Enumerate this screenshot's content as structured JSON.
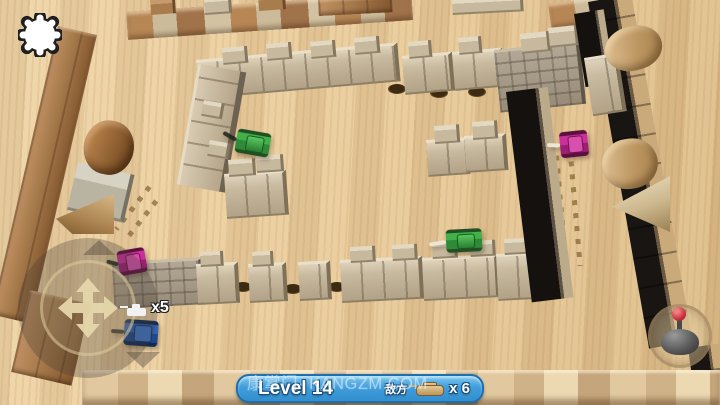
{
  "hud": {
    "settings": {
      "icon": "gear-icon"
    },
    "joystick": {
      "icon": "move-arrows-icon"
    },
    "fire_button": {
      "icon": "fire-joystick-icon"
    },
    "lives": {
      "label": "x5",
      "icon": "player-tank-icon"
    },
    "banner": {
      "level_label": "Level 14",
      "enemy_label": "敌方",
      "enemy_icon": "tank-icon",
      "enemy_count_label": "x 6",
      "bg_color": "#4aa7e2",
      "border_color": "#1d6fb0"
    },
    "watermark": "康掌门· KANGZM.COM"
  },
  "palette": {
    "wood_light": "#eed5a8",
    "wood_mid": "#e3c493",
    "border_wood": "#a5794a",
    "block_tan": "#c9bba0",
    "brick_gray": "#9a8f7c",
    "tank_green": "#3aa43a",
    "tank_purple": "#c02892",
    "tank_blue": "#2f63b5",
    "hole_brown": "#3c2b12"
  },
  "scene": {
    "walls": [
      {
        "x": 58,
        "y": 26,
        "w": 40,
        "h": 296,
        "rot": 13,
        "kind": "wood-border",
        "name": "left-border-wall"
      },
      {
        "x": 30,
        "y": 290,
        "w": 62,
        "h": 84,
        "rot": 13,
        "kind": "wood-border",
        "name": "left-border-bottom"
      },
      {
        "x": 78,
        "y": 162,
        "w": 54,
        "h": 46,
        "rot": 13,
        "kind": "gray-cube",
        "name": "left-border-cube"
      },
      {
        "x": 126,
        "y": 12,
        "w": 286,
        "h": 28,
        "rot": -4,
        "kind": "mixed-border",
        "name": "top-border-wall"
      },
      {
        "x": 150,
        "y": 0,
        "w": 22,
        "h": 15,
        "rot": -4,
        "kind": "wood-cube",
        "name": "top-border-cren-1"
      },
      {
        "x": 204,
        "y": -2,
        "w": 24,
        "h": 15,
        "rot": -4,
        "kind": "tan-cube",
        "name": "top-border-cren-2"
      },
      {
        "x": 258,
        "y": -4,
        "w": 24,
        "h": 15,
        "rot": -4,
        "kind": "wood-cube",
        "name": "top-border-cren-3"
      },
      {
        "x": 318,
        "y": 0,
        "w": 74,
        "h": 16,
        "rot": -3,
        "kind": "wood-border",
        "name": "top-edge-block-1"
      },
      {
        "x": 452,
        "y": 0,
        "w": 68,
        "h": 13,
        "rot": -3,
        "kind": "tan-cube",
        "name": "top-edge-block-2"
      },
      {
        "x": 548,
        "y": 4,
        "w": 54,
        "h": 26,
        "rot": -8,
        "kind": "mixed-border",
        "name": "top-right-corner-block"
      },
      {
        "x": 588,
        "y": 2,
        "w": 44,
        "h": 352,
        "rot": -10,
        "kind": "dark-border",
        "name": "right-border-wall"
      },
      {
        "x": 688,
        "y": 348,
        "w": 34,
        "h": 56,
        "rot": -8,
        "kind": "dark-border",
        "name": "bottom-right-corner"
      },
      {
        "x": 82,
        "y": 370,
        "w": 638,
        "h": 35,
        "rot": 0,
        "kind": "light-border",
        "name": "bottom-border-wall"
      },
      {
        "x": 196,
        "y": 60,
        "w": 198,
        "h": 34,
        "rot": -5,
        "kind": "tan-wall",
        "name": "inner-top-wall"
      },
      {
        "x": 222,
        "y": 48,
        "w": 22,
        "h": 15,
        "rot": -5,
        "kind": "tan-cube",
        "name": "inner-top-cren-1"
      },
      {
        "x": 266,
        "y": 44,
        "w": 22,
        "h": 15,
        "rot": -5,
        "kind": "tan-cube",
        "name": "inner-top-cren-2"
      },
      {
        "x": 310,
        "y": 42,
        "w": 22,
        "h": 15,
        "rot": -5,
        "kind": "tan-cube",
        "name": "inner-top-cren-3"
      },
      {
        "x": 354,
        "y": 38,
        "w": 22,
        "h": 15,
        "rot": -5,
        "kind": "tan-cube",
        "name": "inner-top-cren-4"
      },
      {
        "x": 402,
        "y": 56,
        "w": 46,
        "h": 34,
        "rot": -5,
        "kind": "tan-wall",
        "name": "inner-top-seg-2"
      },
      {
        "x": 408,
        "y": 42,
        "w": 20,
        "h": 15,
        "rot": -5,
        "kind": "tan-cube",
        "name": "inner-top-cren-5"
      },
      {
        "x": 452,
        "y": 52,
        "w": 46,
        "h": 34,
        "rot": -5,
        "kind": "tan-wall",
        "name": "inner-top-seg-3"
      },
      {
        "x": 458,
        "y": 38,
        "w": 20,
        "h": 15,
        "rot": -5,
        "kind": "tan-cube",
        "name": "inner-top-cren-6"
      },
      {
        "x": 494,
        "y": 50,
        "w": 82,
        "h": 60,
        "rot": -6,
        "kind": "brick-wall",
        "name": "inner-top-brick-stack"
      },
      {
        "x": 520,
        "y": 34,
        "w": 26,
        "h": 18,
        "rot": -6,
        "kind": "tan-cube",
        "name": "brick-stack-cren-1"
      },
      {
        "x": 548,
        "y": 28,
        "w": 26,
        "h": 18,
        "rot": -6,
        "kind": "tan-cube",
        "name": "brick-stack-cren-2"
      },
      {
        "x": 574,
        "y": 14,
        "w": 30,
        "h": 74,
        "rot": -9,
        "kind": "dark-wall",
        "name": "top-right-dark-wall"
      },
      {
        "x": 584,
        "y": 58,
        "w": 30,
        "h": 54,
        "rot": -9,
        "kind": "tan-wall",
        "name": "right-side-block"
      },
      {
        "x": 198,
        "y": 64,
        "w": 40,
        "h": 122,
        "rot": 10,
        "kind": "tan-wall-v",
        "name": "inner-left-wall"
      },
      {
        "x": 204,
        "y": 100,
        "w": 18,
        "h": 14,
        "rot": 10,
        "kind": "tan-cube",
        "name": "inner-left-cren-a"
      },
      {
        "x": 210,
        "y": 140,
        "w": 18,
        "h": 14,
        "rot": 10,
        "kind": "tan-cube",
        "name": "inner-left-cren-b"
      },
      {
        "x": 224,
        "y": 174,
        "w": 58,
        "h": 40,
        "rot": -4,
        "kind": "tan-wall",
        "name": "inner-left-block"
      },
      {
        "x": 228,
        "y": 160,
        "w": 24,
        "h": 15,
        "rot": -4,
        "kind": "tan-cube",
        "name": "inner-left-cren-1"
      },
      {
        "x": 256,
        "y": 156,
        "w": 24,
        "h": 15,
        "rot": -4,
        "kind": "tan-cube",
        "name": "inner-left-cren-2"
      },
      {
        "x": 426,
        "y": 140,
        "w": 38,
        "h": 32,
        "rot": -4,
        "kind": "tan-wall",
        "name": "mid-cross-block-1"
      },
      {
        "x": 434,
        "y": 126,
        "w": 22,
        "h": 16,
        "rot": -4,
        "kind": "tan-cube",
        "name": "mid-cross-cren-1"
      },
      {
        "x": 464,
        "y": 136,
        "w": 38,
        "h": 32,
        "rot": -4,
        "kind": "tan-wall",
        "name": "mid-cross-block-2"
      },
      {
        "x": 472,
        "y": 122,
        "w": 22,
        "h": 16,
        "rot": -4,
        "kind": "tan-cube",
        "name": "mid-cross-cren-2"
      },
      {
        "x": 112,
        "y": 262,
        "w": 86,
        "h": 44,
        "rot": -3,
        "kind": "brick-wall",
        "name": "inner-bottom-brick"
      },
      {
        "x": 196,
        "y": 264,
        "w": 38,
        "h": 36,
        "rot": -3,
        "kind": "tan-wall",
        "name": "inner-bottom-seg-1"
      },
      {
        "x": 248,
        "y": 264,
        "w": 34,
        "h": 34,
        "rot": -3,
        "kind": "tan-wall",
        "name": "inner-bottom-seg-2"
      },
      {
        "x": 298,
        "y": 262,
        "w": 28,
        "h": 34,
        "rot": -3,
        "kind": "tan-wall",
        "name": "inner-bottom-seg-3"
      },
      {
        "x": 340,
        "y": 260,
        "w": 78,
        "h": 38,
        "rot": -3,
        "kind": "tan-wall",
        "name": "inner-bottom-seg-4"
      },
      {
        "x": 422,
        "y": 258,
        "w": 72,
        "h": 38,
        "rot": -3,
        "kind": "tan-wall",
        "name": "inner-bottom-seg-5"
      },
      {
        "x": 496,
        "y": 254,
        "w": 50,
        "h": 42,
        "rot": -3,
        "kind": "tan-wall",
        "name": "inner-bottom-seg-6"
      },
      {
        "x": 350,
        "y": 247,
        "w": 22,
        "h": 14,
        "rot": -3,
        "kind": "tan-cube",
        "name": "bottom-cren-1"
      },
      {
        "x": 392,
        "y": 245,
        "w": 22,
        "h": 14,
        "rot": -3,
        "kind": "tan-cube",
        "name": "bottom-cren-2"
      },
      {
        "x": 432,
        "y": 243,
        "w": 22,
        "h": 14,
        "rot": -3,
        "kind": "tan-cube",
        "name": "bottom-cren-3"
      },
      {
        "x": 470,
        "y": 241,
        "w": 22,
        "h": 14,
        "rot": -3,
        "kind": "tan-cube",
        "name": "bottom-cren-4"
      },
      {
        "x": 504,
        "y": 239,
        "w": 22,
        "h": 14,
        "rot": -3,
        "kind": "tan-cube",
        "name": "bottom-cren-5"
      },
      {
        "x": 200,
        "y": 252,
        "w": 20,
        "h": 13,
        "rot": -3,
        "kind": "tan-cube",
        "name": "bottom-cren-6"
      },
      {
        "x": 252,
        "y": 252,
        "w": 18,
        "h": 13,
        "rot": -3,
        "kind": "tan-cube",
        "name": "bottom-cren-7"
      },
      {
        "x": 506,
        "y": 92,
        "w": 42,
        "h": 212,
        "rot": -7,
        "kind": "dark-wall",
        "name": "inner-right-wall"
      }
    ],
    "cylinders": [
      {
        "x": 90,
        "y": 116,
        "w": 50,
        "h": 54,
        "rot": 12,
        "kind": "log-dark",
        "name": "left-log"
      },
      {
        "x": 598,
        "y": 144,
        "w": 56,
        "h": 50,
        "rot": -10,
        "kind": "log-light",
        "name": "right-log"
      },
      {
        "x": 600,
        "y": 34,
        "w": 58,
        "h": 44,
        "rot": -14,
        "kind": "log-light",
        "name": "top-right-log"
      }
    ],
    "ramps": [
      {
        "x": 56,
        "y": 194,
        "w": 58,
        "h": 40,
        "kind": "ramp-left",
        "name": "left-ramp"
      },
      {
        "x": 612,
        "y": 176,
        "w": 58,
        "h": 56,
        "kind": "ramp-right",
        "name": "right-ramp"
      }
    ],
    "holes": [
      {
        "x": 388,
        "y": 84
      },
      {
        "x": 430,
        "y": 88
      },
      {
        "x": 468,
        "y": 87
      },
      {
        "x": 234,
        "y": 282
      },
      {
        "x": 284,
        "y": 284
      },
      {
        "x": 328,
        "y": 282
      }
    ],
    "tracks": [
      {
        "x": 146,
        "y": 184,
        "rot": 38,
        "len": 54,
        "name": "track-marks-left"
      },
      {
        "x": 552,
        "y": 156,
        "rot": -5,
        "len": 112,
        "name": "track-marks-right"
      }
    ],
    "tanks": [
      {
        "name": "enemy-tank-green-1",
        "x": 236,
        "y": 131,
        "w": 34,
        "h": 24,
        "rot": 10,
        "color": "green",
        "barrel_len": 15,
        "barrel_light": false,
        "barrel_tilt": 20,
        "z": 3
      },
      {
        "name": "enemy-tank-green-2",
        "x": 446,
        "y": 229,
        "w": 36,
        "h": 23,
        "rot": -3,
        "color": "green",
        "barrel_len": 17,
        "barrel_light": true,
        "barrel_tilt": -6,
        "z": 3
      },
      {
        "name": "enemy-tank-green-3",
        "x": 527,
        "y": 44,
        "w": 34,
        "h": 22,
        "rot": -14,
        "color": "green",
        "barrel_len": 12,
        "barrel_light": false,
        "barrel_tilt": 25,
        "z": 1
      },
      {
        "name": "enemy-tank-purple-1",
        "x": 560,
        "y": 131,
        "w": 28,
        "h": 26,
        "rot": -6,
        "color": "purple",
        "barrel_len": 13,
        "barrel_light": true,
        "barrel_tilt": 8,
        "z": 3
      },
      {
        "name": "enemy-tank-purple-2",
        "x": 118,
        "y": 249,
        "w": 28,
        "h": 25,
        "rot": -10,
        "color": "purple",
        "barrel_len": 12,
        "barrel_light": false,
        "barrel_tilt": 25,
        "z": 3
      },
      {
        "name": "player-tank-blue",
        "x": 124,
        "y": 320,
        "w": 34,
        "h": 26,
        "rot": 4,
        "color": "blue",
        "barrel_len": 13,
        "barrel_light": false,
        "barrel_tilt": 0,
        "z": 3
      }
    ]
  }
}
